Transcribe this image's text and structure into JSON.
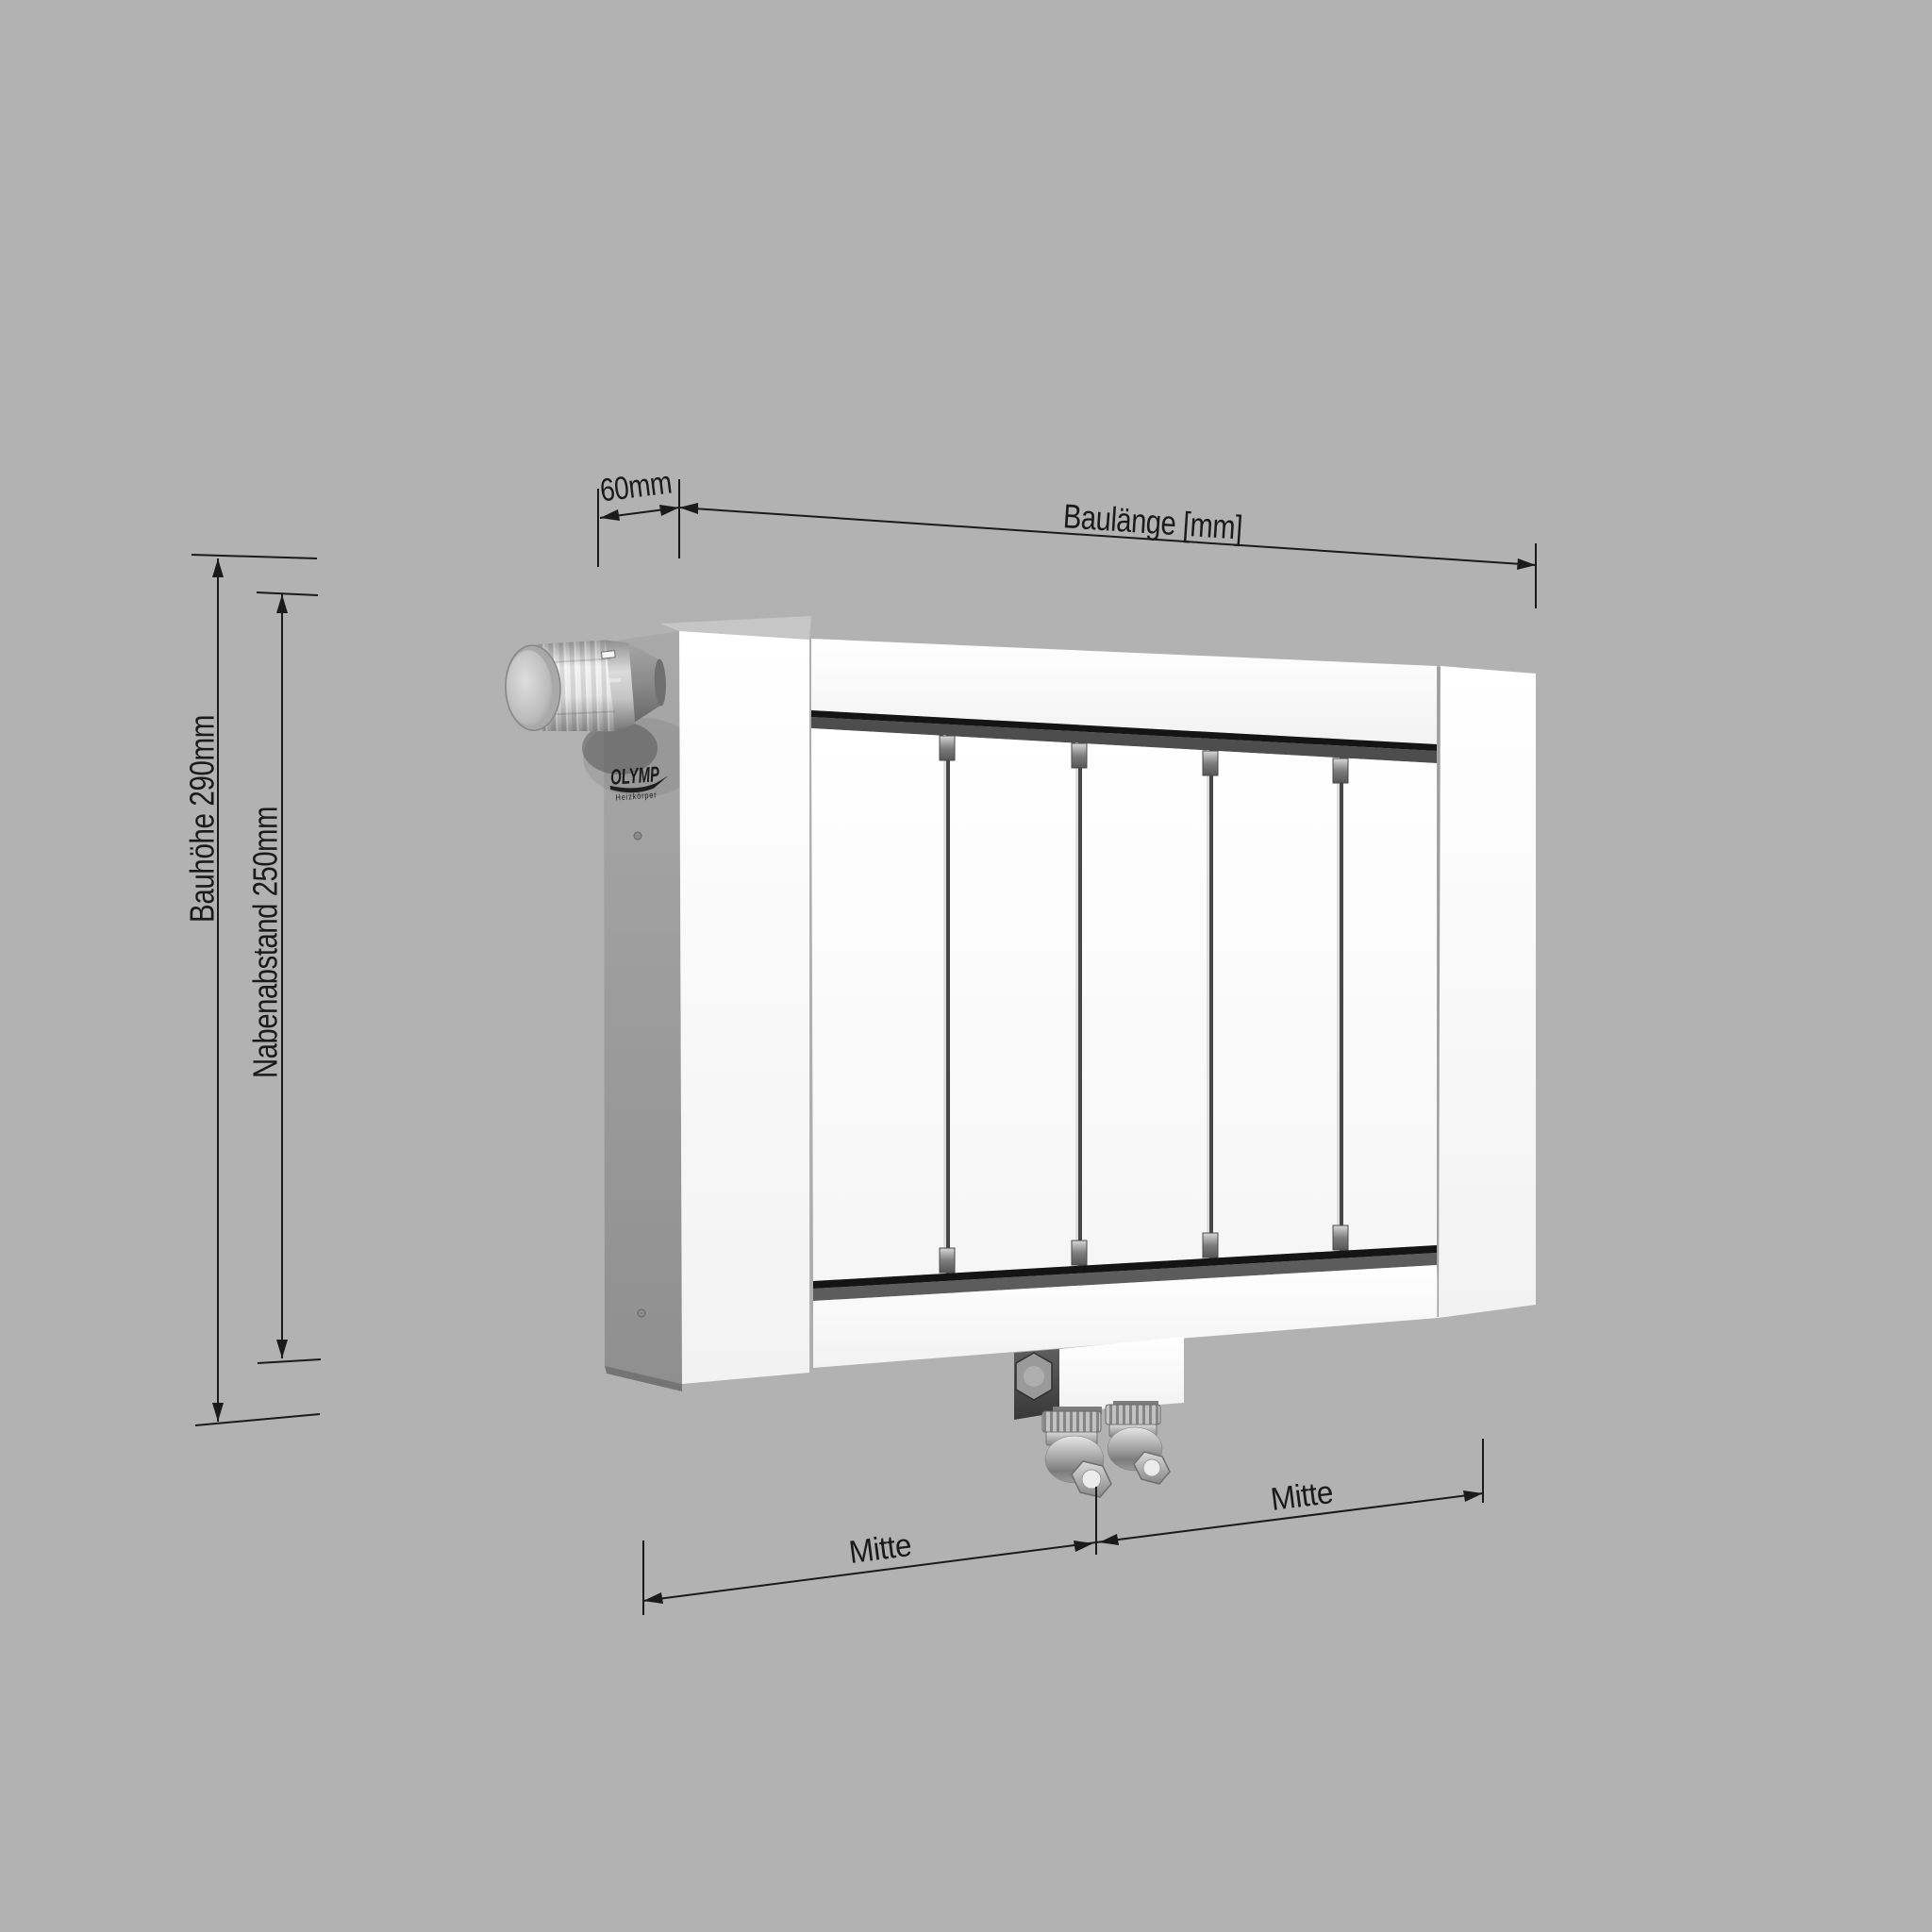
{
  "drawing": {
    "background_color": "#b2b2b2",
    "line_color": "#1a1a1a",
    "labels": {
      "bauhoehe": "Bauhöhe 290mm",
      "nabenabstand": "Nabenabstand 250mm",
      "tiefe": "60mm",
      "baulaenge": "Baulänge [mm]",
      "mitte_links": "Mitte",
      "mitte_rechts": "Mitte"
    },
    "brand": {
      "name": "OLYMP",
      "subtitle": "Heizkörper"
    },
    "radiator": {
      "panel_count": 5,
      "body_color": "#fcfcfc",
      "side_color": "#9a9a9a",
      "groove_color": "#141414",
      "features": [
        "thermostat-knob-top-left",
        "two-bottom-center-valves",
        "bottom-connection-box"
      ]
    }
  }
}
